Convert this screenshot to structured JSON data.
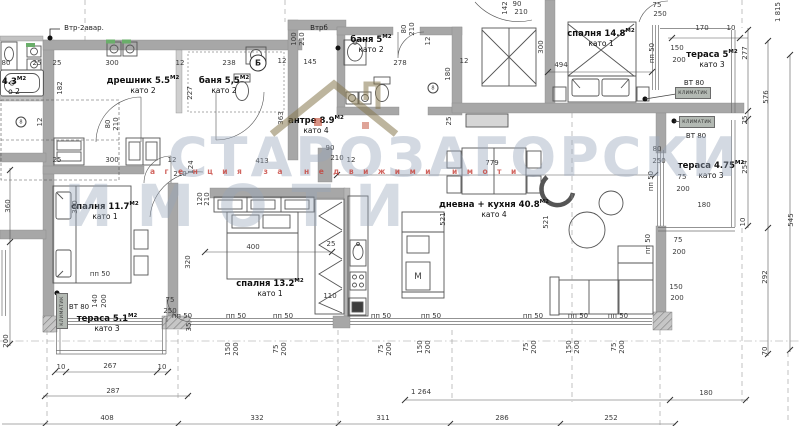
{
  "watermark": {
    "line1": "СТАРОЗАГОРСКИ",
    "line2": "ИМОТИ",
    "tagline": "агенция за недвижими имоти"
  },
  "rooms": [
    {
      "name": "дрешник 5.5",
      "unit": "М2",
      "floor": "като 2",
      "x": 143,
      "y": 85
    },
    {
      "name": "баня 5,5",
      "unit": "М2",
      "floor": "като 2",
      "x": 224,
      "y": 85
    },
    {
      "name": "баня 5",
      "unit": "М2",
      "floor": "като 2",
      "x": 371,
      "y": 44
    },
    {
      "name": "антре 8.9",
      "unit": "М2",
      "floor": "като 4",
      "x": 316,
      "y": 125
    },
    {
      "name": "спалня 14.8",
      "unit": "М2",
      "floor": "като 1",
      "x": 601,
      "y": 38
    },
    {
      "name": "тераса 5",
      "unit": "М2",
      "floor": "като 3",
      "x": 712,
      "y": 59
    },
    {
      "name": "тераса 4.75",
      "unit": "М2",
      "floor": "като 3",
      "x": 711,
      "y": 170
    },
    {
      "name": "спалня 11.7",
      "unit": "М2",
      "floor": "като 1",
      "x": 105,
      "y": 211
    },
    {
      "name": "спалня 13.2",
      "unit": "М2",
      "floor": "като 1",
      "x": 270,
      "y": 288
    },
    {
      "name": "дневна + кухня 40.8",
      "unit": "М2",
      "floor": "като 4",
      "x": 494,
      "y": 209
    },
    {
      "name": "тераса 5.1",
      "unit": "М2",
      "floor": "като 3",
      "x": 107,
      "y": 323
    },
    {
      "name": "4.3",
      "unit": "М2",
      "floor": "о 2",
      "x": 14,
      "y": 86
    }
  ],
  "dims": [
    {
      "t": "80",
      "x": 6,
      "y": 63
    },
    {
      "t": "25",
      "x": 37,
      "y": 63
    },
    {
      "t": "25",
      "x": 57,
      "y": 63
    },
    {
      "t": "300",
      "x": 112,
      "y": 63
    },
    {
      "t": "12",
      "x": 180,
      "y": 63
    },
    {
      "t": "238",
      "x": 229,
      "y": 63
    },
    {
      "t": "145",
      "x": 310,
      "y": 62
    },
    {
      "t": "12",
      "x": 282,
      "y": 61
    },
    {
      "t": "278",
      "x": 400,
      "y": 63
    },
    {
      "t": "12",
      "x": 464,
      "y": 61
    },
    {
      "t": "182",
      "x": 60,
      "y": 88,
      "r": 1
    },
    {
      "t": "227",
      "x": 190,
      "y": 93,
      "r": 1
    },
    {
      "t": "12",
      "x": 40,
      "y": 122,
      "r": 1
    },
    {
      "t": "80",
      "x": 108,
      "y": 124,
      "r": 1
    },
    {
      "t": "210",
      "x": 116,
      "y": 124,
      "r": 1
    },
    {
      "t": "100",
      "x": 294,
      "y": 39,
      "r": 1
    },
    {
      "t": "210",
      "x": 302,
      "y": 39,
      "r": 1
    },
    {
      "t": "80",
      "x": 404,
      "y": 29,
      "r": 1
    },
    {
      "t": "210",
      "x": 412,
      "y": 29,
      "r": 1
    },
    {
      "t": "12",
      "x": 428,
      "y": 41,
      "r": 1
    },
    {
      "t": "142",
      "x": 505,
      "y": 8,
      "r": 1
    },
    {
      "t": "90",
      "x": 517,
      "y": 4
    },
    {
      "t": "210",
      "x": 521,
      "y": 12
    },
    {
      "t": "363",
      "x": 281,
      "y": 118,
      "r": 1
    },
    {
      "t": "180",
      "x": 448,
      "y": 74,
      "r": 1
    },
    {
      "t": "300",
      "x": 541,
      "y": 47,
      "r": 1
    },
    {
      "t": "25",
      "x": 449,
      "y": 121,
      "r": 1
    },
    {
      "t": "494",
      "x": 561,
      "y": 65
    },
    {
      "t": "75",
      "x": 657,
      "y": 5
    },
    {
      "t": "250",
      "x": 660,
      "y": 14
    },
    {
      "t": "170",
      "x": 702,
      "y": 28
    },
    {
      "t": "10",
      "x": 731,
      "y": 28
    },
    {
      "t": "пп 50",
      "x": 652,
      "y": 53,
      "r": 1
    },
    {
      "t": "150",
      "x": 677,
      "y": 48
    },
    {
      "t": "200",
      "x": 679,
      "y": 60
    },
    {
      "t": "277",
      "x": 745,
      "y": 53,
      "r": 1
    },
    {
      "t": "1 815",
      "x": 778,
      "y": 12,
      "r": 1
    },
    {
      "t": "576",
      "x": 766,
      "y": 97,
      "r": 1
    },
    {
      "t": "25",
      "x": 745,
      "y": 120,
      "r": 1
    },
    {
      "t": "254",
      "x": 745,
      "y": 167,
      "r": 1
    },
    {
      "t": "80",
      "x": 657,
      "y": 149
    },
    {
      "t": "250",
      "x": 659,
      "y": 161
    },
    {
      "t": "пп 50",
      "x": 651,
      "y": 181,
      "r": 1
    },
    {
      "t": "75",
      "x": 682,
      "y": 177
    },
    {
      "t": "200",
      "x": 683,
      "y": 189
    },
    {
      "t": "180",
      "x": 704,
      "y": 205
    },
    {
      "t": "10",
      "x": 743,
      "y": 222,
      "r": 1
    },
    {
      "t": "545",
      "x": 791,
      "y": 220,
      "r": 1
    },
    {
      "t": "25",
      "x": 57,
      "y": 160
    },
    {
      "t": "300",
      "x": 112,
      "y": 160
    },
    {
      "t": "12",
      "x": 172,
      "y": 160
    },
    {
      "t": "210",
      "x": 180,
      "y": 174
    },
    {
      "t": "124",
      "x": 191,
      "y": 167,
      "r": 1
    },
    {
      "t": "120",
      "x": 200,
      "y": 199,
      "r": 1
    },
    {
      "t": "210",
      "x": 207,
      "y": 199,
      "r": 1
    },
    {
      "t": "413",
      "x": 262,
      "y": 161
    },
    {
      "t": "90",
      "x": 330,
      "y": 148
    },
    {
      "t": "210",
      "x": 337,
      "y": 158
    },
    {
      "t": "12",
      "x": 351,
      "y": 160
    },
    {
      "t": "390",
      "x": 75,
      "y": 207,
      "r": 1
    },
    {
      "t": "360",
      "x": 8,
      "y": 206,
      "r": 1
    },
    {
      "t": "320",
      "x": 188,
      "y": 262,
      "r": 1
    },
    {
      "t": "400",
      "x": 253,
      "y": 247
    },
    {
      "t": "25",
      "x": 331,
      "y": 244
    },
    {
      "t": "110",
      "x": 330,
      "y": 296
    },
    {
      "t": "779",
      "x": 492,
      "y": 163
    },
    {
      "t": "521",
      "x": 443,
      "y": 219,
      "r": 1
    },
    {
      "t": "521",
      "x": 546,
      "y": 222,
      "r": 1
    },
    {
      "t": "292",
      "x": 765,
      "y": 277,
      "r": 1
    },
    {
      "t": "70",
      "x": 765,
      "y": 351,
      "r": 1
    },
    {
      "t": "пп 50",
      "x": 648,
      "y": 244,
      "r": 1
    },
    {
      "t": "75",
      "x": 678,
      "y": 240
    },
    {
      "t": "200",
      "x": 679,
      "y": 252
    },
    {
      "t": "150",
      "x": 676,
      "y": 287
    },
    {
      "t": "200",
      "x": 677,
      "y": 298
    },
    {
      "t": "пп 50",
      "x": 182,
      "y": 316
    },
    {
      "t": "пп 50",
      "x": 236,
      "y": 316
    },
    {
      "t": "пп 50",
      "x": 283,
      "y": 316
    },
    {
      "t": "пп 50",
      "x": 381,
      "y": 316
    },
    {
      "t": "пп 50",
      "x": 431,
      "y": 316
    },
    {
      "t": "пп 50",
      "x": 533,
      "y": 316
    },
    {
      "t": "пп 50",
      "x": 578,
      "y": 316
    },
    {
      "t": "пп 50",
      "x": 618,
      "y": 316
    },
    {
      "t": "150",
      "x": 228,
      "y": 349,
      "r": 1
    },
    {
      "t": "200",
      "x": 236,
      "y": 349,
      "r": 1
    },
    {
      "t": "75",
      "x": 276,
      "y": 349,
      "r": 1
    },
    {
      "t": "200",
      "x": 284,
      "y": 349,
      "r": 1
    },
    {
      "t": "75",
      "x": 381,
      "y": 349,
      "r": 1
    },
    {
      "t": "200",
      "x": 389,
      "y": 349,
      "r": 1
    },
    {
      "t": "150",
      "x": 420,
      "y": 347,
      "r": 1
    },
    {
      "t": "200",
      "x": 428,
      "y": 347,
      "r": 1
    },
    {
      "t": "75",
      "x": 526,
      "y": 347,
      "r": 1
    },
    {
      "t": "200",
      "x": 534,
      "y": 347,
      "r": 1
    },
    {
      "t": "150",
      "x": 569,
      "y": 347,
      "r": 1
    },
    {
      "t": "200",
      "x": 577,
      "y": 347,
      "r": 1
    },
    {
      "t": "75",
      "x": 614,
      "y": 347,
      "r": 1
    },
    {
      "t": "200",
      "x": 622,
      "y": 347,
      "r": 1
    },
    {
      "t": "200",
      "x": 6,
      "y": 341,
      "r": 1
    },
    {
      "t": "140",
      "x": 95,
      "y": 301,
      "r": 1
    },
    {
      "t": "200",
      "x": 104,
      "y": 301,
      "r": 1
    },
    {
      "t": "пп 50",
      "x": 100,
      "y": 274
    },
    {
      "t": "75",
      "x": 170,
      "y": 300
    },
    {
      "t": "250",
      "x": 170,
      "y": 311
    },
    {
      "t": "35",
      "x": 189,
      "y": 327,
      "r": 1
    },
    {
      "t": "10",
      "x": 61,
      "y": 367
    },
    {
      "t": "267",
      "x": 110,
      "y": 366
    },
    {
      "t": "10",
      "x": 162,
      "y": 367
    },
    {
      "t": "287",
      "x": 113,
      "y": 391
    },
    {
      "t": "1 264",
      "x": 421,
      "y": 392
    },
    {
      "t": "180",
      "x": 706,
      "y": 393
    },
    {
      "t": "408",
      "x": 107,
      "y": 418
    },
    {
      "t": "332",
      "x": 257,
      "y": 418
    },
    {
      "t": "311",
      "x": 383,
      "y": 418
    },
    {
      "t": "286",
      "x": 502,
      "y": 418
    },
    {
      "t": "252",
      "x": 611,
      "y": 418
    }
  ],
  "notes": [
    {
      "t": "Втр-2авар.",
      "x": 84,
      "y": 28,
      "cls": "note"
    },
    {
      "t": "Втрб",
      "x": 319,
      "y": 28,
      "cls": "note"
    },
    {
      "t": "ВТ 80",
      "x": 694,
      "y": 83,
      "cls": "note"
    },
    {
      "t": "ВТ 80",
      "x": 696,
      "y": 136,
      "cls": "note"
    },
    {
      "t": "ВТ 80",
      "x": 79,
      "y": 307,
      "cls": "note"
    },
    {
      "t": "КЛИМАТИК",
      "x": 693,
      "y": 93,
      "cls": "badge"
    },
    {
      "t": "КЛИМАТИК",
      "x": 697,
      "y": 122,
      "cls": "badge"
    },
    {
      "t": "КЛИМАТИК",
      "x": 62,
      "y": 311,
      "cls": "badge-v"
    },
    {
      "t": "М",
      "x": 418,
      "y": 277,
      "cls": "appliance"
    },
    {
      "t": "Б",
      "x": 258,
      "y": 63,
      "cls": "circle"
    },
    {
      "t": "8",
      "x": 433,
      "y": 88,
      "cls": "circle-sm"
    },
    {
      "t": "8",
      "x": 21,
      "y": 122,
      "cls": "circle-sm"
    }
  ]
}
